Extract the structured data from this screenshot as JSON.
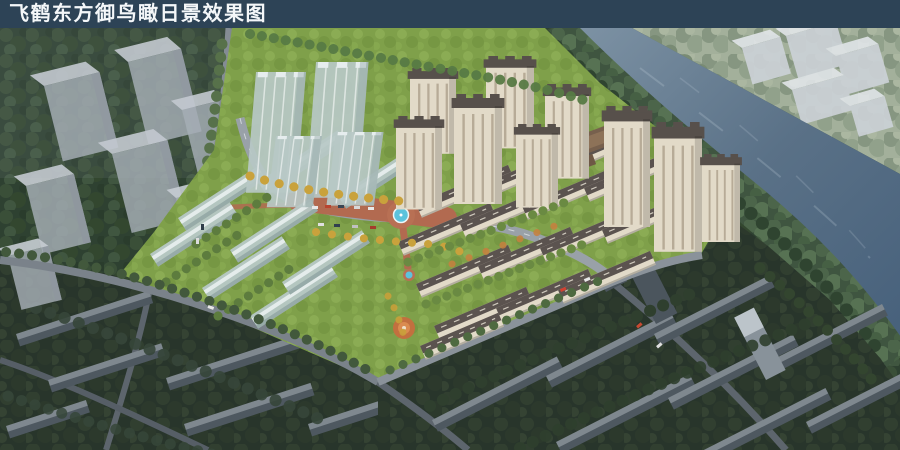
{
  "header": {
    "title": "飞鹤东方御鸟瞰日景效果图"
  },
  "palette": {
    "header_bg": "#2d4356",
    "header_text": "#f4f7f9",
    "water": "#6e8598",
    "water_deep": "#47607b",
    "far_bank": "#93a287",
    "forest_dark": "#2e4131",
    "forest_dim": "#28352b",
    "bank_trees": "#3f5540",
    "lawn": "#7fa04a",
    "tree_green": "#5f8040",
    "tree_yellow": "#c9a23c",
    "tree_orange": "#c87f3e",
    "glass_building": "#b7c8c6",
    "cream_wall": "#e2dac8",
    "roof_dark": "#57504b",
    "ghost_building": "#a6aeb6",
    "context_building": "#4e5860",
    "road_light": "#99a1a8",
    "road_dark": "#5d656d",
    "plaza_paving": "#b26a50",
    "pool": "#5cc3dc"
  },
  "scene": {
    "type": "architectural-aerial-rendering",
    "time_of_day": "day",
    "features": [
      "river",
      "riverside-tree-belt",
      "high-rise-residential-towers",
      "mid-rise-apartment-rows",
      "translucent-massing-blocks",
      "central-plaza-with-round-pool",
      "playground",
      "ghost-context-blocks",
      "dark-context-housing-rows",
      "perimeter-roads-with-cars"
    ]
  }
}
